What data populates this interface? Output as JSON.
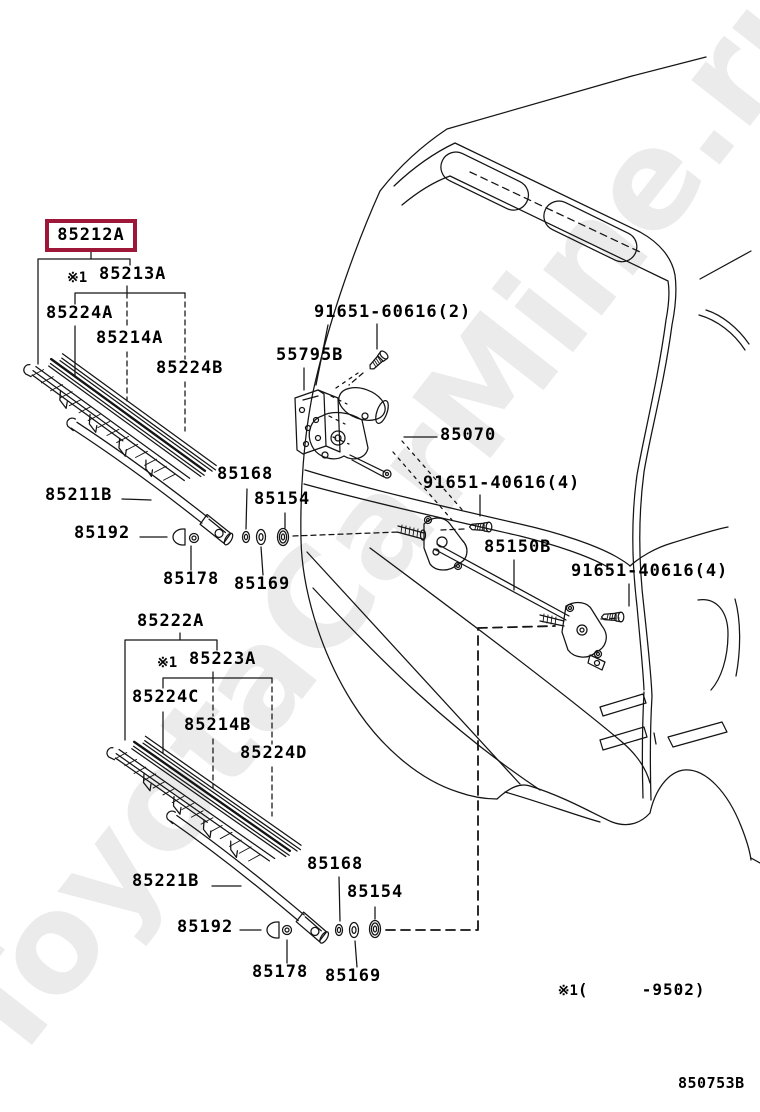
{
  "watermark_text": "ToyotaCarMine.ru",
  "figure_code": "850753B",
  "footnote": {
    "marker": "※1",
    "range": "(     -9502)"
  },
  "colors": {
    "highlight_box": "#9E1638",
    "ink": "#000000",
    "paper": "#FFFFFF"
  },
  "upper_wiper": {
    "blade_assy": "85212A",
    "blade_note": "※1",
    "blade": "85213A",
    "backing_a": "85224A",
    "rubber": "85214A",
    "backing_b": "85224B",
    "arm": "85211B",
    "cap": "85192",
    "nut": "85178",
    "washer_inner": "85168",
    "washer_outer": "85169",
    "grommet": "85154"
  },
  "lower_wiper": {
    "blade_assy": "85222A",
    "blade_note": "※1",
    "blade": "85223A",
    "backing_a": "85224C",
    "rubber": "85214B",
    "backing_b": "85224D",
    "arm": "85221B",
    "cap": "85192",
    "nut": "85178",
    "washer_inner": "85168",
    "washer_outer": "85169",
    "grommet": "85154"
  },
  "motor_link": {
    "motor": "85070",
    "link": "85150B",
    "bracket": "55795B",
    "screw_motor": "91651-60616(2)",
    "screw_pivot": "91651-40616(4)"
  }
}
